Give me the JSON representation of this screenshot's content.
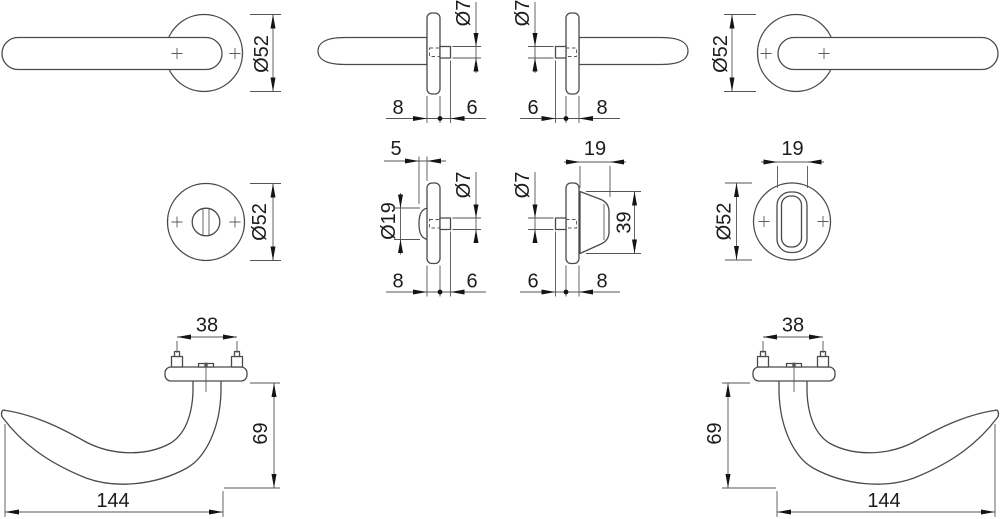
{
  "page": {
    "background": "#ffffff",
    "line_color": "#4a4a4a",
    "dimension_line_color": "#555555",
    "text_color": "#1c1c1c",
    "description": "Technical dimension drawing of door lever handle set with round rosettes and WC thumbturn"
  },
  "figures": {
    "lever_front_left": {
      "rosette_diameter": "Ø52"
    },
    "lever_side_left": {
      "spindle_diameter": "Ø7",
      "rosette_thickness": "8",
      "spindle_projection": "6"
    },
    "lever_side_right": {
      "spindle_diameter": "Ø7",
      "spindle_projection": "6",
      "rosette_thickness": "8"
    },
    "lever_front_right": {
      "rosette_diameter": "Ø52"
    },
    "wc_rosette_front": {
      "rosette_diameter": "Ø52"
    },
    "wc_release_side": {
      "release_projection": "5",
      "release_diameter": "Ø19",
      "spindle_diameter": "Ø7",
      "rosette_thickness": "8",
      "spindle_projection": "6"
    },
    "thumbturn_side": {
      "knob_projection": "19",
      "spindle_diameter": "Ø7",
      "knob_height": "39",
      "spindle_projection": "6",
      "rosette_thickness": "8"
    },
    "thumbturn_front": {
      "knob_width": "19",
      "rosette_diameter": "Ø52"
    },
    "lever_plan_left": {
      "screw_spacing": "38",
      "projection": "69",
      "length": "144"
    },
    "lever_plan_right": {
      "screw_spacing": "38",
      "projection": "69",
      "length": "144"
    }
  }
}
